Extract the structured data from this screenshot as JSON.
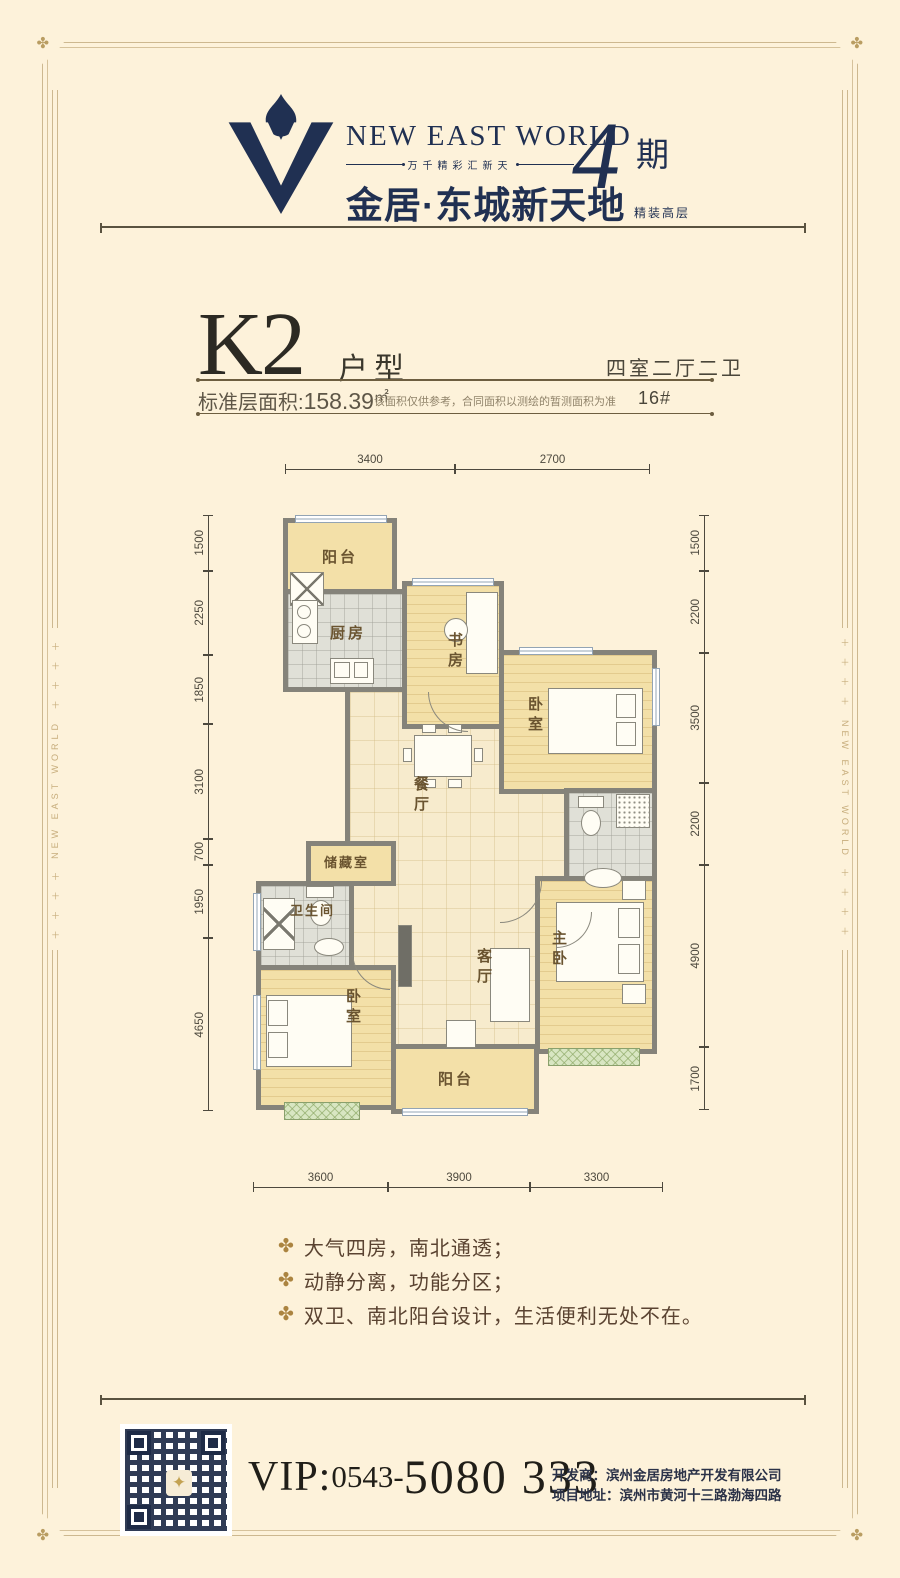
{
  "frame": {
    "corner_icon": "✤",
    "side_plus": "＋ ＋ ＋ ＋",
    "side_text": "NEW EAST WORLD"
  },
  "logo": {
    "brand_en": "NEW EAST WORLD",
    "tagline": "万千精彩汇新天",
    "brand_cn": "金居·东城新天地",
    "phase_number": "4",
    "phase_label": "期",
    "phase_sub": "精装高层"
  },
  "title": {
    "plan_code": "K2",
    "plan_type_label": "户型",
    "rooms_summary": "四室二厅二卫",
    "area_label": "标准层面积:",
    "area_value": "158.39",
    "area_unit": "㎡",
    "disclaimer": "该面积仅供参考，合同面积以测绘的暂测面积为准",
    "building_no": "16#"
  },
  "floorplan": {
    "rooms": {
      "balcony_top": "阳台",
      "kitchen": "厨房",
      "study": "书房",
      "bedroom_ne": "卧室",
      "dining": "餐厅",
      "storage": "储藏室",
      "bath_main": "卫生间",
      "living": "客厅",
      "master": "主卧",
      "bedroom_sw": "卧室",
      "balcony_bottom": "阳台"
    },
    "dims": {
      "top": [
        "3400",
        "2700"
      ],
      "left": [
        "1500",
        "2250",
        "1850",
        "3100",
        "700",
        "1950",
        "4650"
      ],
      "right": [
        "1500",
        "2200",
        "3500",
        "2200",
        "4900",
        "1700"
      ],
      "bottom": [
        "3600",
        "3900",
        "3300"
      ]
    }
  },
  "features": {
    "icon": "✤",
    "items": [
      "大气四房，南北通透；",
      "动静分离，功能分区；",
      "双卫、南北阳台设计，生活便利无处不在。"
    ]
  },
  "footer": {
    "vip_label": "VIP:",
    "phone_area": "0543-",
    "phone_number": "5080 333",
    "developer_line": "开发商：滨州金居房地产开发有限公司",
    "address_line": "项目地址：滨州市黄河十三路渤海四路"
  }
}
